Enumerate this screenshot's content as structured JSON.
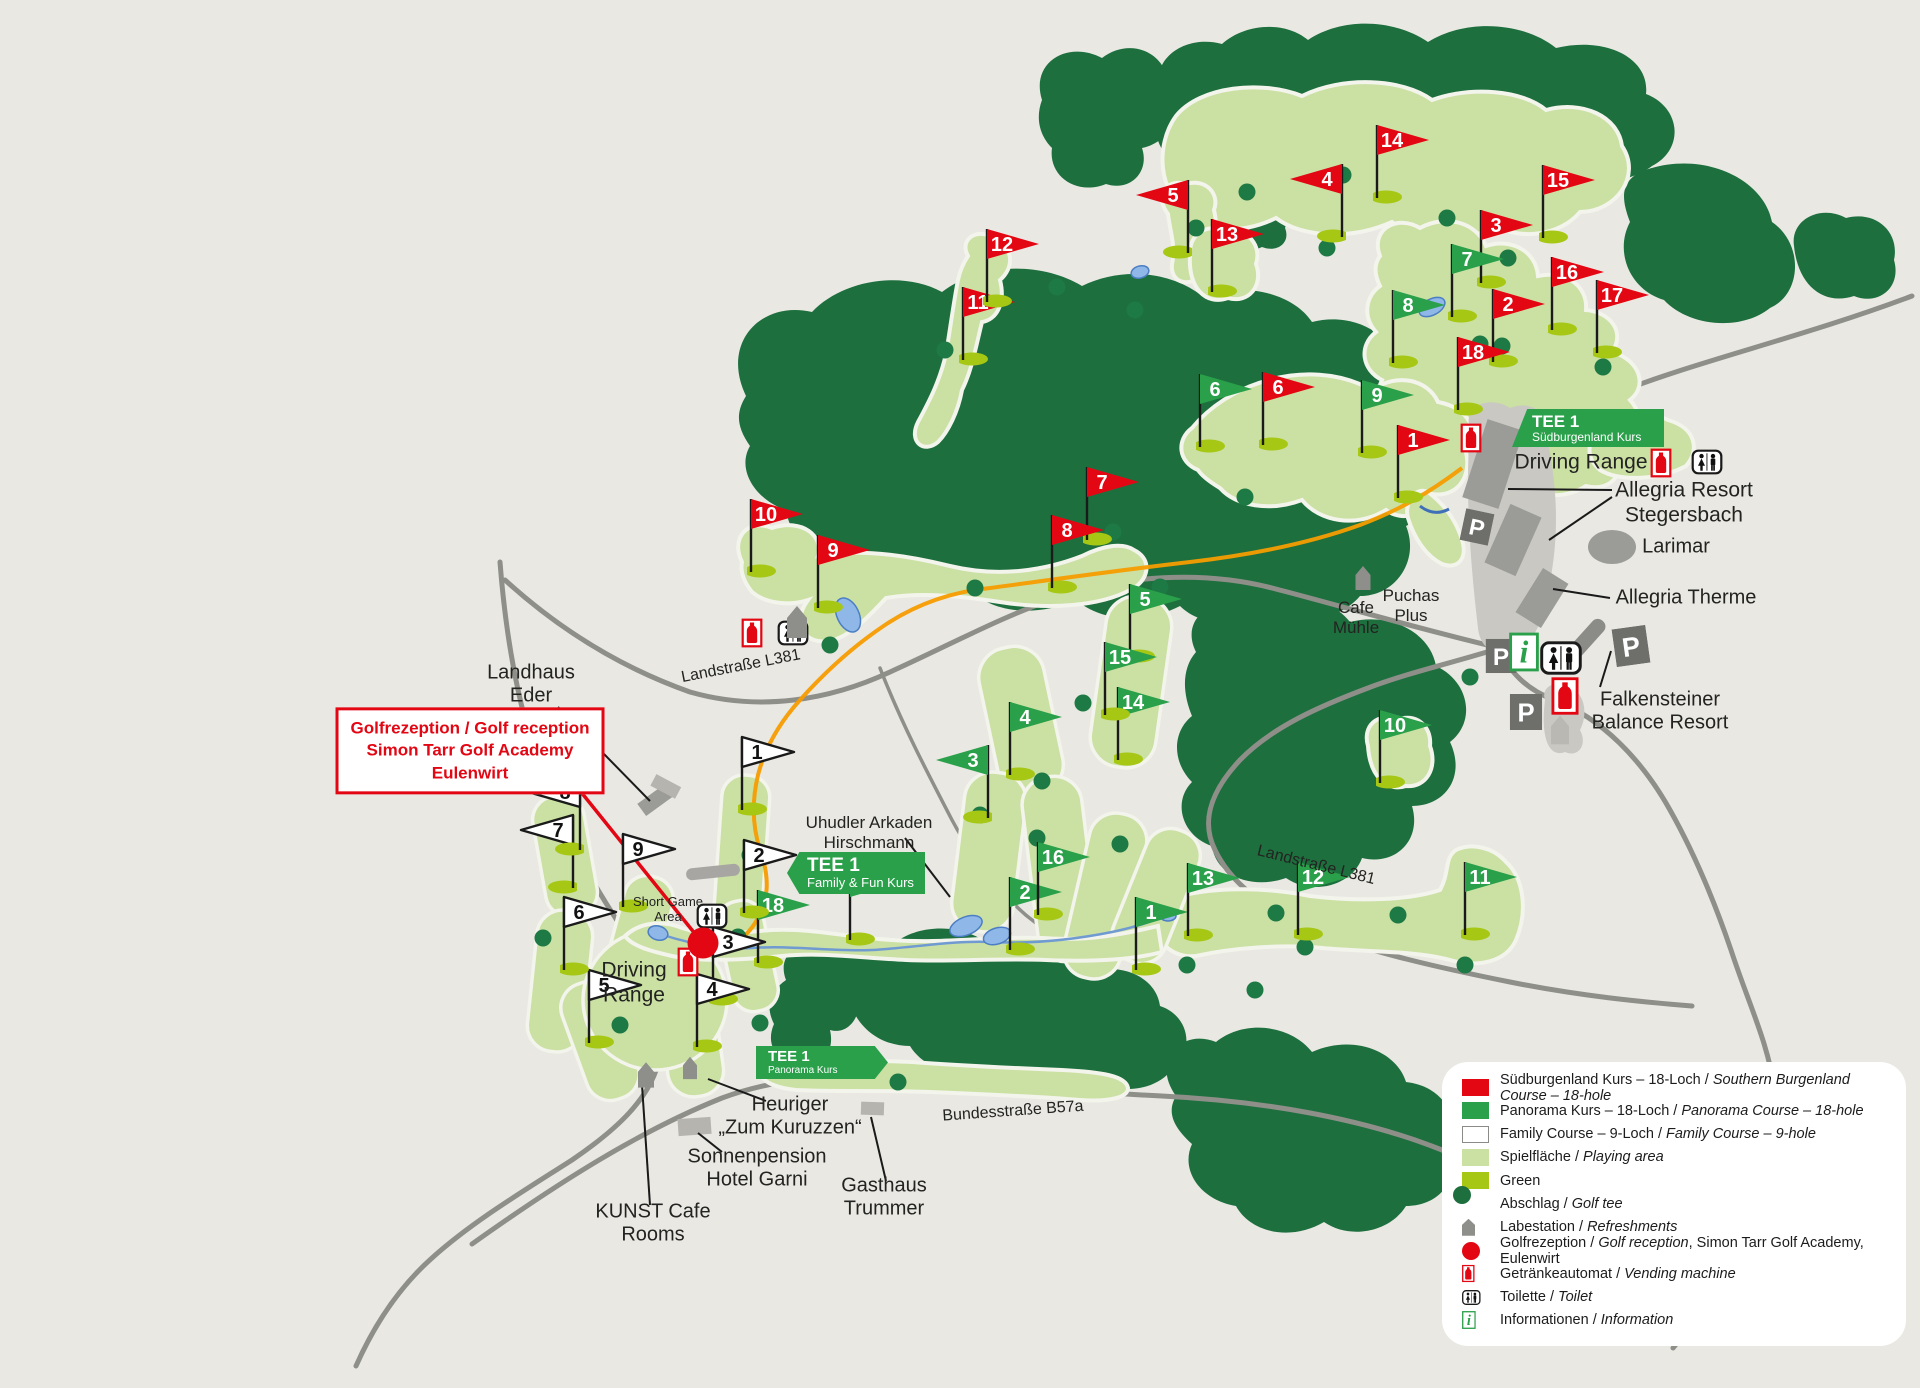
{
  "colors": {
    "red": "#e30613",
    "green": "#2aa04a",
    "forest": "#1d6f3e",
    "fairway": "#cbe0a3",
    "putting_green": "#a6c713",
    "tee": "#1e7a44",
    "background": "#e9e8e3",
    "road": "#8f8f89",
    "water": "#8fb7e8",
    "orange_trail": "#f59c00"
  },
  "banners": [
    {
      "id": "tee1-suedburgenland",
      "title": "TEE 1",
      "subtitle": "Südburgenland Kurs",
      "x": 1512,
      "y": 409,
      "w": 152,
      "h": 38,
      "tip": "skew"
    },
    {
      "id": "tee1-family",
      "title": "TEE 1",
      "subtitle": "Family & Fun Kurs",
      "x": 787,
      "y": 852,
      "w": 138,
      "h": 42,
      "tip": "left"
    },
    {
      "id": "tee1-panorama",
      "title": "TEE 1",
      "subtitle": "Panorama Kurs",
      "x": 756,
      "y": 1046,
      "w": 132,
      "h": 33,
      "tip": "right"
    }
  ],
  "reception_box": {
    "lines": [
      "Golfrezeption / Golf reception",
      "Simon Tarr Golf Academy",
      "Eulenwirt"
    ],
    "x": 470,
    "y": 751
  },
  "labels": [
    {
      "id": "driving-range-top",
      "t": "Driving Range",
      "x": 1581,
      "y": 463,
      "fs": 21
    },
    {
      "id": "allegria-resort",
      "t": "Allegria Resort\nStegersbach",
      "x": 1684,
      "y": 503,
      "fs": 21
    },
    {
      "id": "larimar",
      "t": "Larimar",
      "x": 1676,
      "y": 547,
      "fs": 20
    },
    {
      "id": "allegria-therme",
      "t": "Allegria Therme",
      "x": 1686,
      "y": 598,
      "fs": 20
    },
    {
      "id": "cafe-muehle",
      "t": "Cafe\nMühle",
      "x": 1356,
      "y": 618,
      "fs": 17
    },
    {
      "id": "puchas-plus",
      "t": "Puchas\nPlus",
      "x": 1411,
      "y": 606,
      "fs": 17
    },
    {
      "id": "falkensteiner",
      "t": "Falkensteiner\nBalance Resort",
      "x": 1660,
      "y": 712,
      "fs": 20
    },
    {
      "id": "landhaus-eder",
      "t": "Landhaus\nEder",
      "x": 531,
      "y": 685,
      "fs": 20
    },
    {
      "id": "uhudler-arkaden",
      "t": "Uhudler Arkaden\nHirschmann",
      "x": 869,
      "y": 833,
      "fs": 17
    },
    {
      "id": "short-game-area",
      "t": "Short Game\nArea",
      "x": 668,
      "y": 909,
      "fs": 13
    },
    {
      "id": "driving-range-family",
      "t": "Driving\nRange",
      "x": 634,
      "y": 983,
      "fs": 21
    },
    {
      "id": "heuriger",
      "t": "Heuriger\n„Zum Kuruzzen“",
      "x": 790,
      "y": 1117,
      "fs": 20
    },
    {
      "id": "sonnenpension",
      "t": "Sonnenpension\nHotel Garni",
      "x": 757,
      "y": 1169,
      "fs": 20
    },
    {
      "id": "kunst-cafe",
      "t": "KUNST Cafe\nRooms",
      "x": 653,
      "y": 1224,
      "fs": 20
    },
    {
      "id": "gasthaus-trummer",
      "t": "Gasthaus\nTrummer",
      "x": 884,
      "y": 1198,
      "fs": 20
    },
    {
      "id": "bundesstrasse-b57a",
      "t": "Bundesstraße B57a",
      "x": 1013,
      "y": 1112,
      "fs": 16,
      "rot": -4
    },
    {
      "id": "landstrasse-l381-west",
      "t": "Landstraße L381",
      "x": 741,
      "y": 667,
      "fs": 16,
      "rot": -11
    },
    {
      "id": "landstrasse-l381-east",
      "t": "Landstraße L381",
      "x": 1316,
      "y": 866,
      "fs": 16,
      "rot": 14
    }
  ],
  "flags": [
    {
      "course": "red",
      "n": "1",
      "x": 1398,
      "y": 498
    },
    {
      "course": "red",
      "n": "2",
      "x": 1493,
      "y": 362
    },
    {
      "course": "red",
      "n": "3",
      "x": 1481,
      "y": 283
    },
    {
      "course": "red",
      "n": "4",
      "x": 1342,
      "y": 237,
      "dir": "l"
    },
    {
      "course": "red",
      "n": "5",
      "x": 1188,
      "y": 253,
      "dir": "l"
    },
    {
      "course": "red",
      "n": "6",
      "x": 1263,
      "y": 445
    },
    {
      "course": "red",
      "n": "7",
      "x": 1087,
      "y": 540
    },
    {
      "course": "red",
      "n": "8",
      "x": 1052,
      "y": 588
    },
    {
      "course": "red",
      "n": "9",
      "x": 818,
      "y": 608
    },
    {
      "course": "red",
      "n": "10",
      "x": 751,
      "y": 572
    },
    {
      "course": "red",
      "n": "11",
      "x": 963,
      "y": 360
    },
    {
      "course": "red",
      "n": "12",
      "x": 987,
      "y": 302
    },
    {
      "course": "red",
      "n": "13",
      "x": 1212,
      "y": 292
    },
    {
      "course": "red",
      "n": "14",
      "x": 1377,
      "y": 198
    },
    {
      "course": "red",
      "n": "15",
      "x": 1543,
      "y": 238
    },
    {
      "course": "red",
      "n": "16",
      "x": 1552,
      "y": 330
    },
    {
      "course": "red",
      "n": "17",
      "x": 1597,
      "y": 353
    },
    {
      "course": "red",
      "n": "18",
      "x": 1458,
      "y": 410
    },
    {
      "course": "green",
      "n": "1",
      "x": 1136,
      "y": 970
    },
    {
      "course": "green",
      "n": "2",
      "x": 1010,
      "y": 950
    },
    {
      "course": "green",
      "n": "3",
      "x": 988,
      "y": 818,
      "dir": "l"
    },
    {
      "course": "green",
      "n": "4",
      "x": 1010,
      "y": 775
    },
    {
      "course": "green",
      "n": "5",
      "x": 1130,
      "y": 657
    },
    {
      "course": "green",
      "n": "6",
      "x": 1200,
      "y": 447
    },
    {
      "course": "green",
      "n": "7",
      "x": 1452,
      "y": 317
    },
    {
      "course": "green",
      "n": "8",
      "x": 1393,
      "y": 363
    },
    {
      "course": "green",
      "n": "9",
      "x": 1362,
      "y": 453
    },
    {
      "course": "green",
      "n": "10",
      "x": 1380,
      "y": 783
    },
    {
      "course": "green",
      "n": "11",
      "x": 1465,
      "y": 935
    },
    {
      "course": "green",
      "n": "12",
      "x": 1298,
      "y": 935
    },
    {
      "course": "green",
      "n": "13",
      "x": 1188,
      "y": 936
    },
    {
      "course": "green",
      "n": "14",
      "x": 1118,
      "y": 760
    },
    {
      "course": "green",
      "n": "15",
      "x": 1105,
      "y": 715
    },
    {
      "course": "green",
      "n": "16",
      "x": 1038,
      "y": 915
    },
    {
      "course": "green",
      "n": "17",
      "x": 850,
      "y": 940
    },
    {
      "course": "green",
      "n": "18",
      "x": 758,
      "y": 963
    },
    {
      "course": "white",
      "n": "1",
      "x": 742,
      "y": 810
    },
    {
      "course": "white",
      "n": "2",
      "x": 744,
      "y": 913
    },
    {
      "course": "white",
      "n": "3",
      "x": 713,
      "y": 1000
    },
    {
      "course": "white",
      "n": "4",
      "x": 697,
      "y": 1047
    },
    {
      "course": "white",
      "n": "5",
      "x": 589,
      "y": 1043
    },
    {
      "course": "white",
      "n": "6",
      "x": 564,
      "y": 970
    },
    {
      "course": "white",
      "n": "7",
      "x": 573,
      "y": 888,
      "dir": "l"
    },
    {
      "course": "white",
      "n": "8",
      "x": 580,
      "y": 850,
      "dir": "l"
    },
    {
      "course": "white",
      "n": "9",
      "x": 623,
      "y": 907
    }
  ],
  "icons": [
    {
      "type": "vending",
      "x": 1661,
      "y": 463
    },
    {
      "type": "toilet",
      "x": 1707,
      "y": 462
    },
    {
      "type": "vending",
      "x": 1471,
      "y": 438
    },
    {
      "type": "vending",
      "x": 752,
      "y": 633
    },
    {
      "type": "toilet",
      "x": 793,
      "y": 633
    },
    {
      "type": "toilet",
      "x": 712,
      "y": 916
    },
    {
      "type": "vending",
      "x": 688,
      "y": 962
    },
    {
      "type": "parking",
      "x": 1477,
      "y": 527,
      "rot": 12,
      "s": 0.85
    },
    {
      "type": "parking",
      "x": 1501,
      "y": 656,
      "s": 0.9
    },
    {
      "type": "info",
      "x": 1524,
      "y": 652,
      "s": 1.3
    },
    {
      "type": "toilet",
      "x": 1561,
      "y": 658,
      "s": 1.35
    },
    {
      "type": "parking",
      "x": 1631,
      "y": 646,
      "rot": -8
    },
    {
      "type": "parking",
      "x": 1526,
      "y": 712,
      "s": 0.95
    },
    {
      "type": "vending",
      "x": 1565,
      "y": 696,
      "s": 1.3
    },
    {
      "type": "pin",
      "x": 797,
      "y": 622
    },
    {
      "type": "pin",
      "x": 1363,
      "y": 578,
      "s": 0.75
    },
    {
      "type": "pin",
      "x": 1560,
      "y": 730,
      "s": 0.9,
      "light": true
    },
    {
      "type": "pin",
      "x": 646,
      "y": 1075,
      "s": 0.8
    },
    {
      "type": "pin",
      "x": 690,
      "y": 1068,
      "s": 0.7
    },
    {
      "type": "reception",
      "x": 703,
      "y": 943
    }
  ],
  "pointer_lines": {
    "black": [
      [
        558,
        707,
        650,
        801
      ],
      [
        905,
        838,
        950,
        897
      ],
      [
        1612,
        490,
        1508,
        489
      ],
      [
        1612,
        497,
        1549,
        540
      ],
      [
        1610,
        598,
        1553,
        589
      ],
      [
        1600,
        687,
        1611,
        651
      ],
      [
        766,
        1101,
        708,
        1079
      ],
      [
        650,
        1205,
        642,
        1085
      ],
      [
        722,
        1152,
        698,
        1133
      ],
      [
        886,
        1181,
        871,
        1117
      ]
    ],
    "red": [
      [
        577,
        787,
        700,
        940
      ]
    ]
  },
  "tees": [
    [
      1196,
      228
    ],
    [
      1343,
      175
    ],
    [
      1327,
      248
    ],
    [
      1508,
      258
    ],
    [
      1057,
      287
    ],
    [
      945,
      350
    ],
    [
      1135,
      310
    ],
    [
      1480,
      344
    ],
    [
      1502,
      346
    ],
    [
      1603,
      367
    ],
    [
      1160,
      587
    ],
    [
      1113,
      532
    ],
    [
      830,
      645
    ],
    [
      975,
      588
    ],
    [
      1083,
      703
    ],
    [
      1042,
      781
    ],
    [
      1120,
      844
    ],
    [
      1276,
      913
    ],
    [
      1187,
      965
    ],
    [
      1255,
      990
    ],
    [
      1465,
      965
    ],
    [
      1398,
      915
    ],
    [
      543,
      938
    ],
    [
      620,
      1025
    ],
    [
      760,
      1023
    ],
    [
      738,
      937
    ],
    [
      980,
      815
    ],
    [
      750,
      855
    ],
    [
      1037,
      838
    ],
    [
      1245,
      497
    ],
    [
      1470,
      677
    ],
    [
      898,
      1082
    ],
    [
      1305,
      947
    ],
    [
      1447,
      218
    ],
    [
      1247,
      192
    ]
  ],
  "legend": {
    "items": [
      {
        "sw": "red",
        "de": "Südburgenland Kurs – 18-Loch",
        "en": "Southern Burgenland Course – 18-hole",
        "suffix": ""
      },
      {
        "sw": "green",
        "de": "Panorama Kurs – 18-Loch",
        "en": "Panorama Course – 18-hole",
        "suffix": ""
      },
      {
        "sw": "white",
        "de": "Family Course – 9-Loch",
        "en": "Family Course – 9-hole",
        "suffix": ""
      },
      {
        "sw": "lightgreen",
        "de": "Spielfläche",
        "en": "Playing area",
        "suffix": ""
      },
      {
        "sw": "yellowgreen",
        "de": "Green",
        "en": "",
        "suffix": ""
      },
      {
        "sw": "tee",
        "de": "Abschlag",
        "en": "Golf tee",
        "suffix": ""
      },
      {
        "sw": "pin",
        "de": "Labestation",
        "en": "Refreshments",
        "suffix": ""
      },
      {
        "sw": "reception",
        "de": "Golfrezeption",
        "en": "Golf reception",
        "suffix": ", Simon Tarr Golf Academy, Eulenwirt"
      },
      {
        "sw": "vending",
        "de": "Getränkeautomat",
        "en": "Vending machine",
        "suffix": ""
      },
      {
        "sw": "toilet",
        "de": "Toilette",
        "en": "Toilet",
        "suffix": ""
      },
      {
        "sw": "info",
        "de": "Informationen",
        "en": "Information",
        "suffix": ""
      }
    ]
  }
}
